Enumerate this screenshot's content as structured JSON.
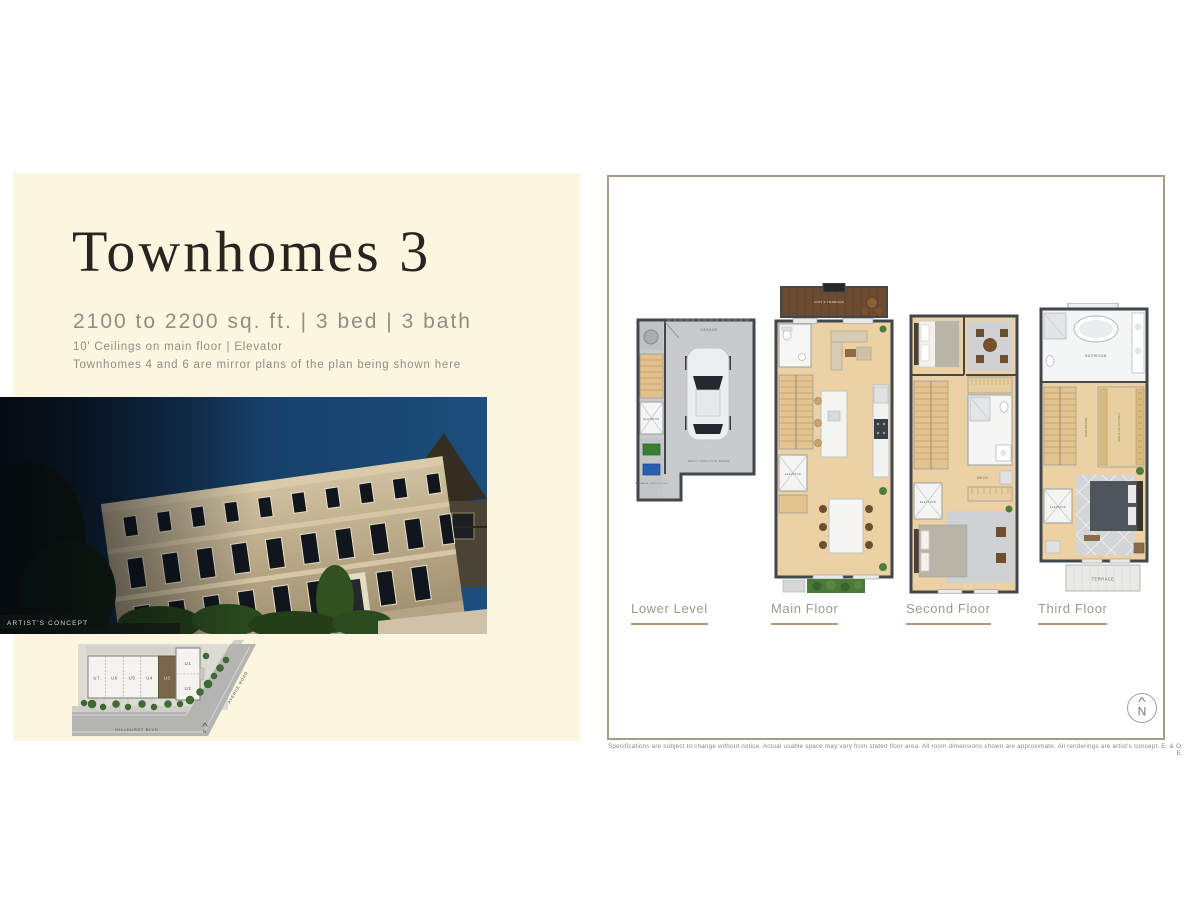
{
  "left_panel": {
    "title": "Townhomes 3",
    "specs": "2100 to 2200 sq. ft.  |  3 bed  |  3 bath",
    "details_line1": "10' Ceilings on main floor  |  Elevator",
    "details_line2": "Townhomes 4 and 6 are mirror plans of the plan being shown here",
    "photo_caption": "ARTIST'S CONCEPT"
  },
  "site_plan": {
    "units": [
      "U7",
      "U6",
      "U5",
      "U4",
      "U3",
      "U1",
      "U2"
    ],
    "highlighted_unit": "U3",
    "street_bottom": "HILLHURST BLVD",
    "street_right": "AVENUE ROAD",
    "north_label": "N"
  },
  "floor_plans": {
    "tabs": [
      {
        "label": "Lower Level"
      },
      {
        "label": "Main Floor"
      },
      {
        "label": "Second Floor"
      },
      {
        "label": "Third Floor"
      }
    ],
    "rooms": {
      "garage": "GARAGE",
      "multi_function": "MULTI-FUNCTION SPACE",
      "garbage": "GARBAGE / RECYCLING",
      "elevator": "ELEVATOR",
      "unit_terrace": "UNIT 3 TERRACE",
      "mech": "MECH.",
      "bathroom": "BATHROOM",
      "wardrobe": "WARDROBE",
      "walk_in_closet": "WALK-IN CLOSET",
      "terrace": "TERRACE"
    }
  },
  "compass": {
    "north_label": "N"
  },
  "disclaimer": "Specifications are subject to change without notice. Actual usable space may vary from stated floor area. All room dimensions shown are approximate. All renderings are artist's concept. E. & O. E.",
  "colors": {
    "background": "#ffffff",
    "panel_cream": "#fcf5df",
    "accent_tan": "#b3997a",
    "text_dark": "#26251f",
    "text_gray": "#8f8e86",
    "frame_border": "#a69d86"
  }
}
